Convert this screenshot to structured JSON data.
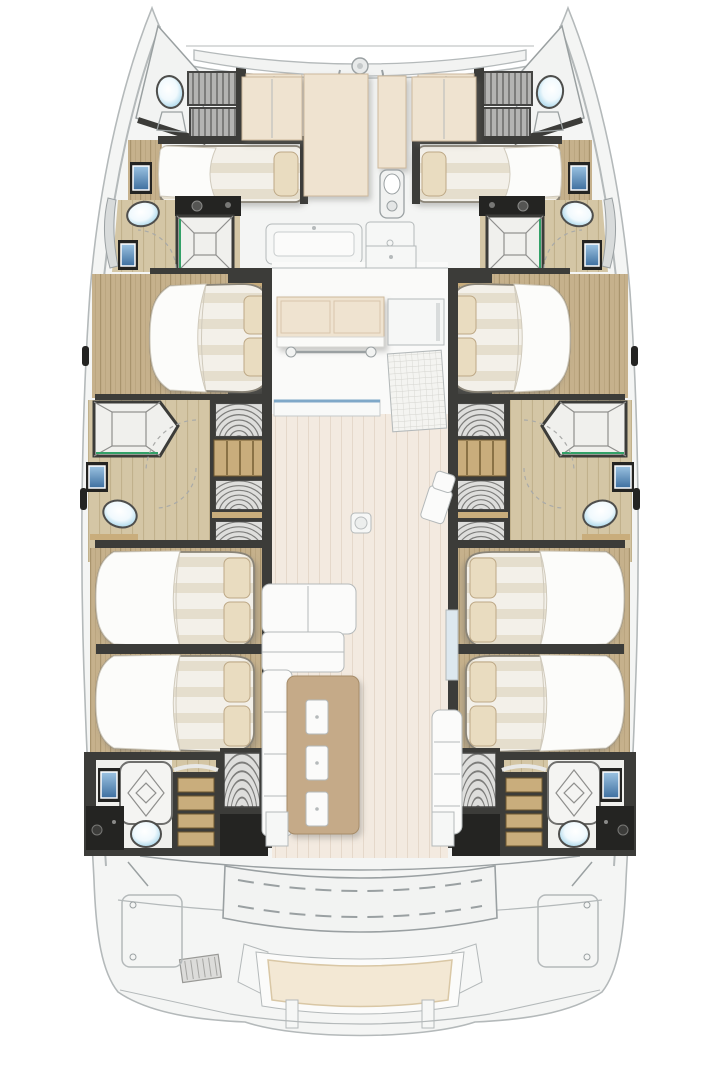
{
  "document": {
    "type": "catamaran-floor-plan",
    "view": "overhead-interior-layout",
    "text_labels": []
  },
  "colors": {
    "hull_fill": "#f4f5f4",
    "hull_stroke": "#b4b9ba",
    "deck_line": "#9aa0a2",
    "wall_dark": "#3c3c39",
    "wall_black": "#242422",
    "wood": "#c6b18c",
    "wood_grain": "#a9946d",
    "wood_light": "#d4c6a5",
    "wood_light_grain": "#c1b18c",
    "salon_floor": "#f3eae0",
    "salon_grain": "#e5d8ca",
    "cream": "#efe3d0",
    "cream_stroke": "#cdb89c",
    "mattress": "#f3f0e9",
    "mattress_band": "#e5decd",
    "mattress_edge": "#8a8477",
    "duvet": "#fcfcfa",
    "duvet_line": "#d0cabc",
    "pillow": "#e9dcc0",
    "pillow_stroke": "#bda886",
    "table": "#c5aa88",
    "table_stroke": "#a68c69",
    "slat": "#b4b4b2",
    "slat_line": "#7d7d7b",
    "shelf": "#dededc",
    "grid_bg": "#f4f4f1",
    "grid_line": "#d5d5d0",
    "bath_floor": "#f0f0ed",
    "toilet_rim": "#4e4e4c",
    "toilet_blue": "#9fd2e8",
    "sink_hi": "#9cc3e2",
    "sink_lo": "#3e6f9f",
    "accent_green": "#33a168",
    "stair_wood": "#c9ad7c",
    "stair_line": "#70592f"
  },
  "features": {
    "bows": 2,
    "port_hull": [
      "forepeak-head",
      "crew-slat-berth",
      "forward-single-berth",
      "forward-bathroom",
      "forward-island-bed",
      "midship-bathroom",
      "wardrobe-stair-column",
      "aft-island-bed-1",
      "aft-island-bed-2",
      "aft-bathroom",
      "companionway-stairs"
    ],
    "starboard_hull": [
      "forepeak-head",
      "crew-slat-berth",
      "forward-single-berth",
      "forward-bathroom",
      "forward-island-bed",
      "midship-bathroom",
      "wardrobe-stair-column",
      "aft-island-bed-1",
      "aft-island-bed-2",
      "aft-bathroom",
      "companionway-stairs"
    ],
    "salon": [
      "galley-counter",
      "towel-rail",
      "aft-galley-counter",
      "entry-grid-mat",
      "dinette-table",
      "table-seat-cushions",
      "l-shaped-sofa",
      "side-bench",
      "floor-hatch",
      "loose-chair"
    ],
    "foredeck": [
      "crossbeam",
      "anchor-windlass",
      "sunpad-left",
      "sunpad-center",
      "sunpad-column",
      "sunpad-right",
      "fore-bench",
      "fore-locker"
    ],
    "aft_deck": [
      "cockpit-bench",
      "aft-seat-cushion",
      "engine-hatch-left",
      "engine-hatch-right",
      "vent-grille",
      "side-locker-port",
      "side-locker-starboard",
      "transom-platform"
    ]
  },
  "counts": {
    "double_island_beds": 6,
    "single_berths": 2,
    "bathrooms": 6,
    "toilets": 8,
    "showers": 6,
    "table_seat_cushions": 3,
    "aft_stair_treads": 4
  }
}
